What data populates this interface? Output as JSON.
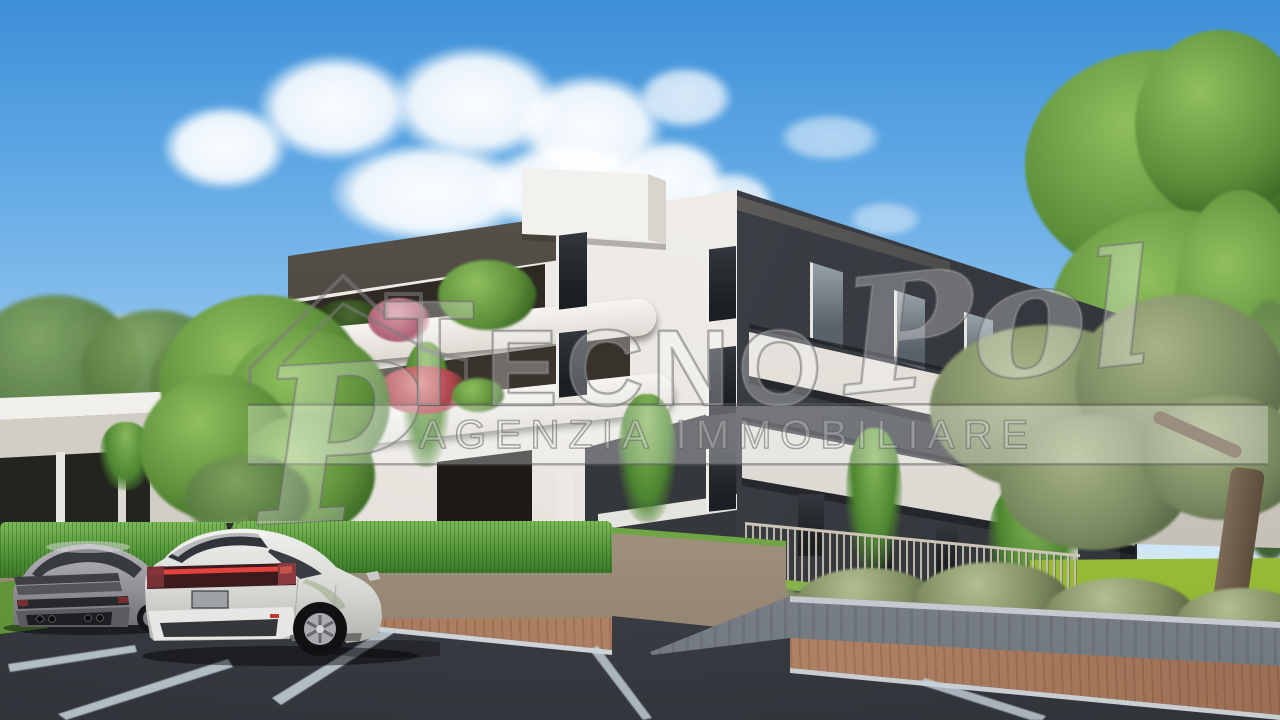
{
  "watermark": {
    "logo_letter": "P",
    "brand_initial": "T",
    "brand_rest": "ECNO",
    "brand_script": "Pol",
    "tagline": "AGENZIA IMMOBILIARE"
  },
  "palette": {
    "sky_top": "#3d8fd8",
    "sky_horizon": "#d9edf9",
    "facade_white": "#efece7",
    "facade_dark": "#41454b",
    "parapet_band": "#57524b",
    "hedge_green": "#5ea23e",
    "lawn_green": "#a6c845",
    "asphalt": "#3f434a",
    "paving_brick": "#a5765a",
    "concrete_tan": "#b6a998",
    "concrete_gray": "#949aa2",
    "watermark_gray": "#8a8a8a"
  }
}
